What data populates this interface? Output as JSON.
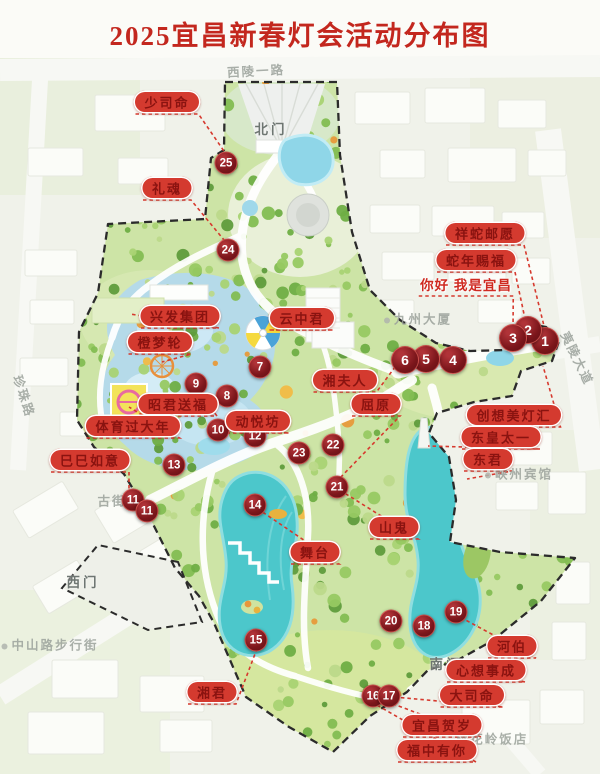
{
  "title": "2025宜昌新春灯会活动分布图",
  "colors": {
    "title_red": "#c3271e",
    "pill_red": "#d43a2f",
    "pill_text": "#8a1310",
    "marker_maroon": "#7c161b",
    "leader_red": "#d6392e",
    "water_teal": "#4cc7cb",
    "park_green": "#cde4a6",
    "boundary_black": "#2b2b2b"
  },
  "map": {
    "markers": [
      {
        "num": "1",
        "x": 545,
        "y": 341,
        "big": true
      },
      {
        "num": "2",
        "x": 528,
        "y": 330,
        "big": true
      },
      {
        "num": "3",
        "x": 513,
        "y": 338,
        "big": true
      },
      {
        "num": "4",
        "x": 453,
        "y": 360,
        "big": true
      },
      {
        "num": "5",
        "x": 426,
        "y": 359,
        "big": true
      },
      {
        "num": "6",
        "x": 405,
        "y": 360,
        "big": true
      },
      {
        "num": "7",
        "x": 260,
        "y": 367,
        "big": false
      },
      {
        "num": "8",
        "x": 227,
        "y": 396,
        "big": false
      },
      {
        "num": "9",
        "x": 196,
        "y": 384,
        "big": false
      },
      {
        "num": "10",
        "x": 218,
        "y": 430,
        "big": false
      },
      {
        "num": "11",
        "x": 133,
        "y": 500,
        "big": false
      },
      {
        "num": "11",
        "x": 147,
        "y": 511,
        "big": false
      },
      {
        "num": "12",
        "x": 255,
        "y": 436,
        "big": false
      },
      {
        "num": "13",
        "x": 174,
        "y": 465,
        "big": false
      },
      {
        "num": "14",
        "x": 255,
        "y": 505,
        "big": false
      },
      {
        "num": "15",
        "x": 256,
        "y": 640,
        "big": false
      },
      {
        "num": "16",
        "x": 373,
        "y": 696,
        "big": false
      },
      {
        "num": "17",
        "x": 389,
        "y": 696,
        "big": false
      },
      {
        "num": "18",
        "x": 424,
        "y": 626,
        "big": false
      },
      {
        "num": "19",
        "x": 456,
        "y": 612,
        "big": false
      },
      {
        "num": "20",
        "x": 391,
        "y": 621,
        "big": false
      },
      {
        "num": "21",
        "x": 337,
        "y": 487,
        "big": false
      },
      {
        "num": "22",
        "x": 333,
        "y": 445,
        "big": false
      },
      {
        "num": "23",
        "x": 299,
        "y": 453,
        "big": false
      },
      {
        "num": "24",
        "x": 228,
        "y": 250,
        "big": false
      },
      {
        "num": "25",
        "x": 226,
        "y": 163,
        "big": false
      }
    ],
    "labels": [
      {
        "text": "少司命",
        "style": "pill",
        "x": 167,
        "y": 102,
        "tx": 228,
        "ty": 157
      },
      {
        "text": "礼魂",
        "style": "pill",
        "x": 167,
        "y": 188,
        "tx": 224,
        "ty": 240
      },
      {
        "text": "祥蛇邮愿",
        "style": "pill",
        "x": 485,
        "y": 233,
        "tx": 546,
        "ty": 334
      },
      {
        "text": "蛇年赐福",
        "style": "pill",
        "x": 476,
        "y": 260,
        "tx": 527,
        "ty": 328
      },
      {
        "text": "你好 我是宜昌",
        "style": "plain",
        "x": 466,
        "y": 284,
        "tx": 513,
        "ty": 332
      },
      {
        "text": "兴发集团",
        "style": "pill",
        "x": 180,
        "y": 316,
        "tx": 130,
        "ty": 314
      },
      {
        "text": "云中君",
        "style": "pill",
        "x": 302,
        "y": 318,
        "tx": 268,
        "ty": 330
      },
      {
        "text": "橙梦轮",
        "style": "pill",
        "x": 160,
        "y": 342,
        "tx": 162,
        "ty": 362
      },
      {
        "text": "昭君送福",
        "style": "pill",
        "x": 178,
        "y": 404,
        "tx": 197,
        "ty": 390
      },
      {
        "text": "体育过大年",
        "style": "pill",
        "x": 133,
        "y": 426,
        "tx": 129,
        "ty": 407
      },
      {
        "text": "动悦坊",
        "style": "pill",
        "x": 258,
        "y": 421,
        "tx": 256,
        "ty": 432
      },
      {
        "text": "湘夫人",
        "style": "pill",
        "x": 345,
        "y": 380,
        "tx": 398,
        "ty": 363
      },
      {
        "text": "屈原",
        "style": "pill",
        "x": 376,
        "y": 404,
        "tx": 338,
        "ty": 480
      },
      {
        "text": "创想美灯汇",
        "style": "pill",
        "x": 514,
        "y": 415,
        "tx": 543,
        "ty": 366
      },
      {
        "text": "东皇太一",
        "style": "pill",
        "x": 501,
        "y": 437,
        "tx": 428,
        "ty": 446
      },
      {
        "text": "东君",
        "style": "pill",
        "x": 488,
        "y": 459,
        "tx": 467,
        "ty": 479
      },
      {
        "text": "巳巳如意",
        "style": "pill",
        "x": 90,
        "y": 460,
        "tx": 129,
        "ty": 494
      },
      {
        "text": "山鬼",
        "style": "pill",
        "x": 394,
        "y": 527,
        "tx": 346,
        "ty": 494
      },
      {
        "text": "舞台",
        "style": "pill",
        "x": 315,
        "y": 552,
        "tx": 261,
        "ty": 511
      },
      {
        "text": "河伯",
        "style": "pill",
        "x": 512,
        "y": 646,
        "tx": 460,
        "ty": 617
      },
      {
        "text": "心想事成",
        "style": "pill",
        "x": 486,
        "y": 670,
        "tx": 447,
        "ty": 662
      },
      {
        "text": "大司命",
        "style": "pill",
        "x": 472,
        "y": 695,
        "tx": 394,
        "ty": 697
      },
      {
        "text": "湘君",
        "style": "pill",
        "x": 212,
        "y": 692,
        "tx": 258,
        "ty": 646
      },
      {
        "text": "宜昌贺岁",
        "style": "pill",
        "x": 442,
        "y": 725,
        "tx": 388,
        "ty": 702
      },
      {
        "text": "福中有你",
        "style": "pill",
        "x": 437,
        "y": 750,
        "tx": 375,
        "ty": 704
      }
    ],
    "streets": [
      {
        "text": "西陵一路",
        "x": 256,
        "y": 70,
        "rot": -3,
        "dot": false
      },
      {
        "text": "夷陵大道",
        "x": 578,
        "y": 358,
        "rot": 64,
        "dot": false
      },
      {
        "text": "珍珠路",
        "x": 25,
        "y": 396,
        "rot": 72,
        "dot": false
      },
      {
        "text": "九州大厦",
        "x": 418,
        "y": 318,
        "rot": 0,
        "dot": true
      },
      {
        "text": "峡州宾馆",
        "x": 519,
        "y": 473,
        "rot": 0,
        "dot": true
      },
      {
        "text": "桃花岭饭店",
        "x": 492,
        "y": 738,
        "rot": 0,
        "dot": false
      },
      {
        "text": "中山路步行街",
        "x": 50,
        "y": 644,
        "rot": 0,
        "dot": true
      },
      {
        "text": "古街",
        "x": 112,
        "y": 500,
        "rot": 0,
        "dot": false
      }
    ],
    "gates": [
      {
        "text": "北门",
        "x": 271,
        "y": 128
      },
      {
        "text": "西门",
        "x": 83,
        "y": 581
      },
      {
        "text": "南门",
        "x": 446,
        "y": 663
      }
    ]
  }
}
